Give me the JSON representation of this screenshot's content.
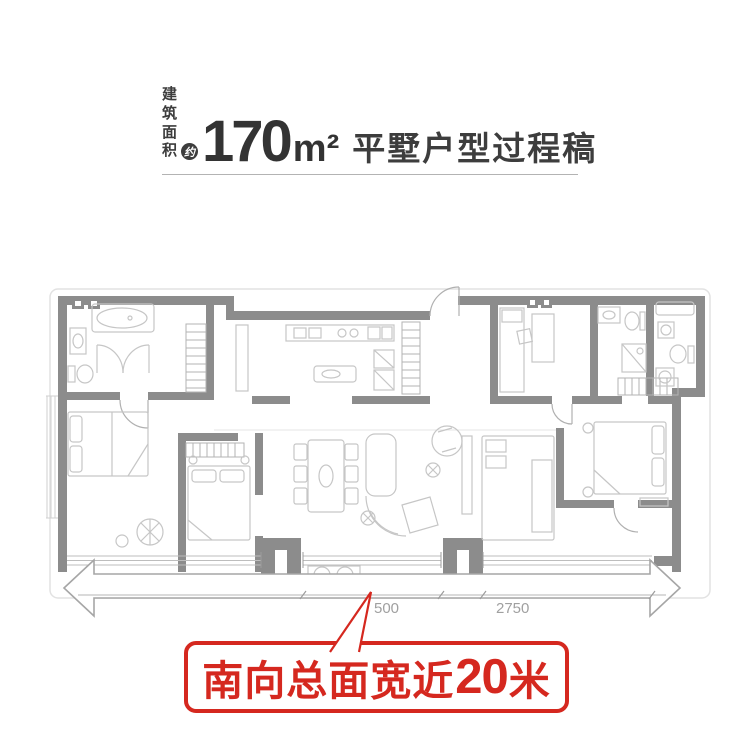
{
  "header": {
    "area_label_top": "建筑",
    "area_label_bottom": "面积",
    "approx_badge": "约",
    "area_value": "170",
    "area_unit": "m²",
    "title": "平墅户型过程稿"
  },
  "plan": {
    "dim_1": "500",
    "dim_2": "2750"
  },
  "callout": {
    "prefix": "南向总面宽近",
    "number": "20",
    "suffix": "米"
  },
  "colors": {
    "accent_red": "#d5281f",
    "wall_gray": "#8c8c8c",
    "furniture_gray": "#c6c6c6",
    "title_dark": "#3d3d3d",
    "dimension_gray": "#a0a0a0"
  }
}
